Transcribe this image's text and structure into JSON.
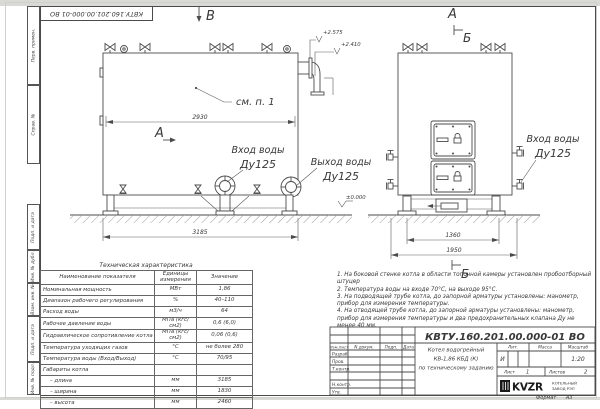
{
  "sheet": {
    "doc_number": "КВТУ.160.201.00.000-01 ВО",
    "format_note": "Формат А3",
    "margin_labels": [
      "Перв. примен.",
      "Справ. №",
      "Подп. и дата",
      "Инв. № дубл.",
      "Взам. инв. №",
      "Подп. и дата",
      "Инв. № подл."
    ]
  },
  "drawing": {
    "view_arrow_top": "В",
    "view_arrow_front": "А",
    "view_arrow_side": "А",
    "section_mark_top": "Б",
    "section_mark_bottom": "Б",
    "note_ref": "см. п. 1",
    "elevation_top": "+2.575",
    "elevation_mid": "+2.410",
    "elevation_zero": "±0.000",
    "dim_side_top": "2930",
    "dim_side_bottom": "3185",
    "dim_front_inner": "1360",
    "dim_front_outer": "1950",
    "inlet_label_line1": "Вход воды",
    "inlet_label_line2": "Ду125",
    "outlet_label_line1": "Выход воды",
    "outlet_label_line2": "Ду125"
  },
  "spec_table": {
    "title": "Техническая характеристика",
    "headers": [
      "Наименование показателя",
      "Единицы измерения",
      "Значение"
    ],
    "rows": [
      [
        "Номинальная мощность",
        "МВт",
        "1,86"
      ],
      [
        "Диапазон рабочего регулирования",
        "%",
        "40–110"
      ],
      [
        "Расход воды",
        "м3/ч",
        "64"
      ],
      [
        "Рабочее давление воды",
        "МПа (кгс/см2)",
        "0,6 (6,0)"
      ],
      [
        "Гидравлическое сопротивление котла",
        "МПа (кгс/см2)",
        "0,06 (0,6)"
      ],
      [
        "Температура уходящих газов",
        "°С",
        "не более 280"
      ],
      [
        "Температура воды (Вход/Выход)",
        "°С",
        "70/95"
      ],
      [
        "Габариты котла",
        "",
        ""
      ],
      [
        "– длина",
        "мм",
        "3185"
      ],
      [
        "– ширина",
        "мм",
        "1830"
      ],
      [
        "– высота",
        "мм",
        "2460"
      ]
    ]
  },
  "notes": {
    "items": [
      "1.  На боковой стенке котла в области топочной камеры установлен пробоотборный штуцер",
      "2.  Температура воды на входе 70°С, на выходе 95°С.",
      "3.  На подводящей трубе котла, до запорной арматуры установлены: манометр, прибор для измерения температуры.",
      "4.  На отводящей трубе котла, до запорной арматуры установлены: манометр, прибор для измерения температуры и два предохранительных клапана Ду не менее 40 мм.",
      "5.  Остальные технические требования по ОСТ 108.030.133-84."
    ]
  },
  "title_block": {
    "doc_number": "КВТУ.160.201.00.000-01 ВО",
    "columns": [
      "Изм.Лист",
      "N докум.",
      "Подп.",
      "Дата"
    ],
    "roles": [
      "Разраб.",
      "Пров.",
      "Т.контр.",
      "Н.контр.",
      "Утв."
    ],
    "product_lines": [
      "Котел водогрейный",
      "КВ-1,86 КБД (К)",
      "по техническому заданию"
    ],
    "lit_header": "Лит.",
    "mass_header": "Масса",
    "scale_header": "Масштаб",
    "lit_value": "И",
    "scale_value": "1:20",
    "sheet_label": "Лист",
    "sheet_number": "1",
    "sheets_label": "Листов",
    "sheets_total": "2",
    "company_logo": "KVZR",
    "company_line1": "КОТЕЛЬНЫЙ",
    "company_line2": "ЗАВОД РЭП"
  }
}
